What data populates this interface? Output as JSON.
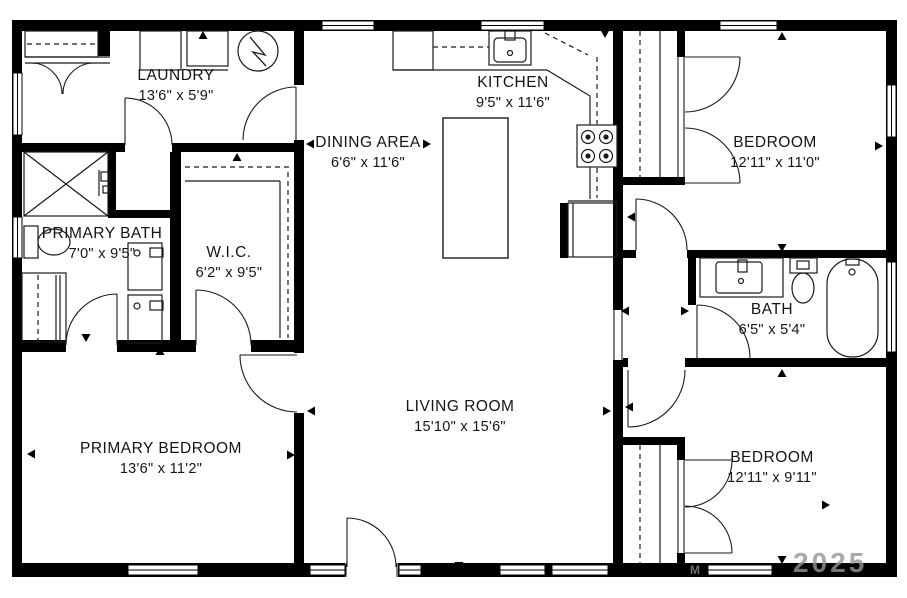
{
  "plan": {
    "rooms": [
      {
        "id": "laundry",
        "name": "LAUNDRY",
        "dims": "13'6\" x 5'9\""
      },
      {
        "id": "kitchen",
        "name": "KITCHEN",
        "dims": "9'5\" x 11'6\""
      },
      {
        "id": "dining",
        "name": "DINING AREA",
        "dims": "6'6\" x 11'6\""
      },
      {
        "id": "bedroom-1",
        "name": "BEDROOM",
        "dims": "12'11\" x 11'0\""
      },
      {
        "id": "primary-bath",
        "name": "PRIMARY BATH",
        "dims": "7'0\" x 9'5\""
      },
      {
        "id": "wic",
        "name": "W.I.C.",
        "dims": "6'2\" x 9'5\""
      },
      {
        "id": "bath",
        "name": "BATH",
        "dims": "6'5\" x 5'4\""
      },
      {
        "id": "living",
        "name": "LIVING ROOM",
        "dims": "15'10\" x 15'6\""
      },
      {
        "id": "primary-bedroom",
        "name": "PRIMARY BEDROOM",
        "dims": "13'6\" x 11'2\""
      },
      {
        "id": "bedroom-2",
        "name": "BEDROOM",
        "dims": "12'11\" x 9'11\""
      }
    ],
    "watermark": "2025",
    "watermark_mark": "M",
    "colors": {
      "wall": "#000000",
      "background": "#ffffff",
      "line": "#1a1a1a",
      "watermark": "#949494"
    }
  }
}
